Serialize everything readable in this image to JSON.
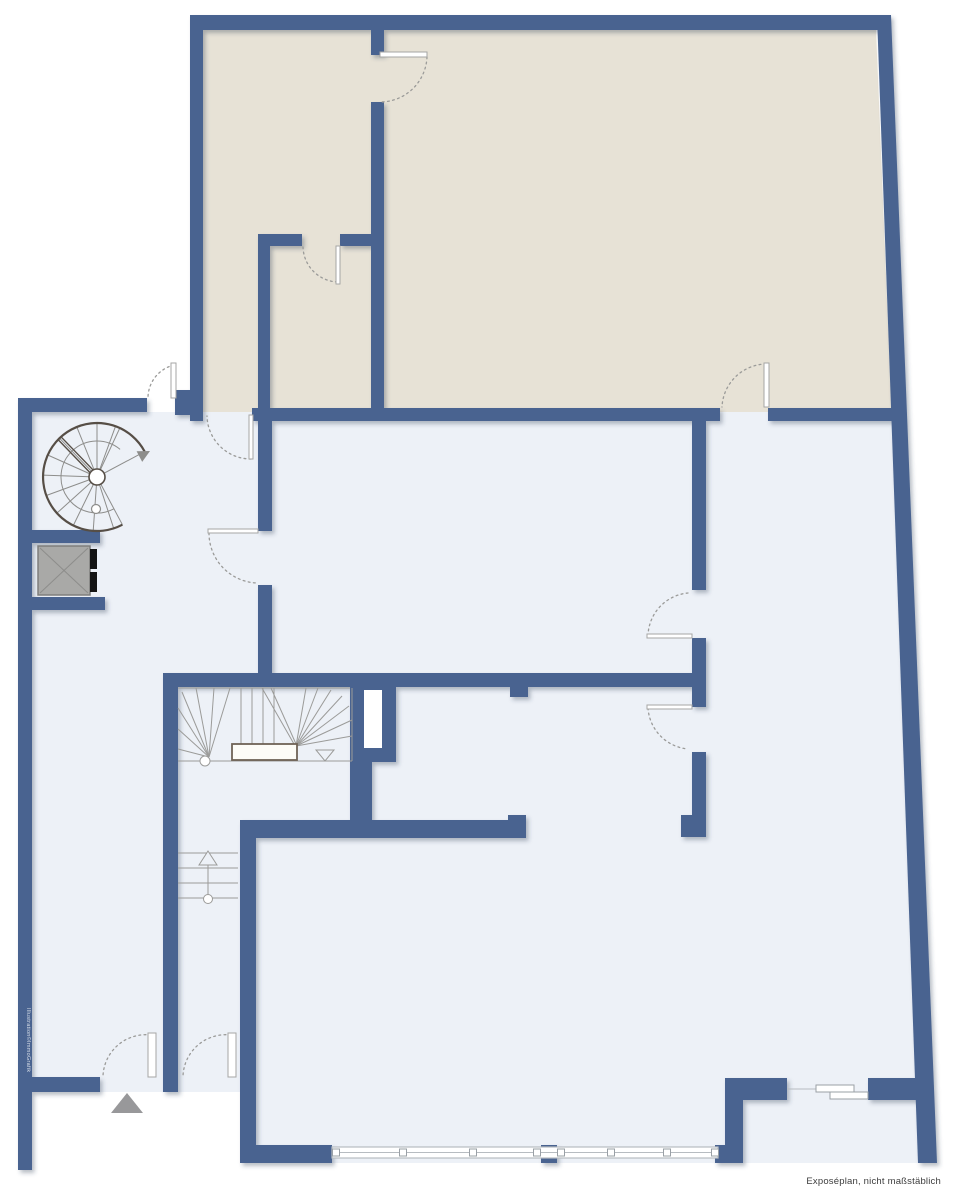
{
  "page": {
    "title": "Exposéplan"
  },
  "annotations": {
    "disclaimer": "Exposéplan, nicht maßstäblich",
    "watermark": "Illustration©ImmoGrafik"
  },
  "colors": {
    "wall": "#4a6490",
    "room_upper": "#e7e2d6",
    "room_main": "#edf1f7",
    "stair_line": "#9b9b99",
    "spiral_dark": "#564e46",
    "landing_border": "#6f6356",
    "elevator_fill": "#a9a9a7",
    "elevator_border": "#7e7e7c",
    "elevator_cross": "#8d8d8b",
    "entry_marker": "#98989a",
    "text": "#3c3c3c",
    "watermark": "#d8dee8",
    "window_line": "#b7bcc1"
  },
  "elements": [
    "spiral-staircase",
    "elevator",
    "winder-staircase",
    "entry-steps",
    "entrance-marker",
    "window-front",
    "sliding-door",
    "door-swing"
  ]
}
